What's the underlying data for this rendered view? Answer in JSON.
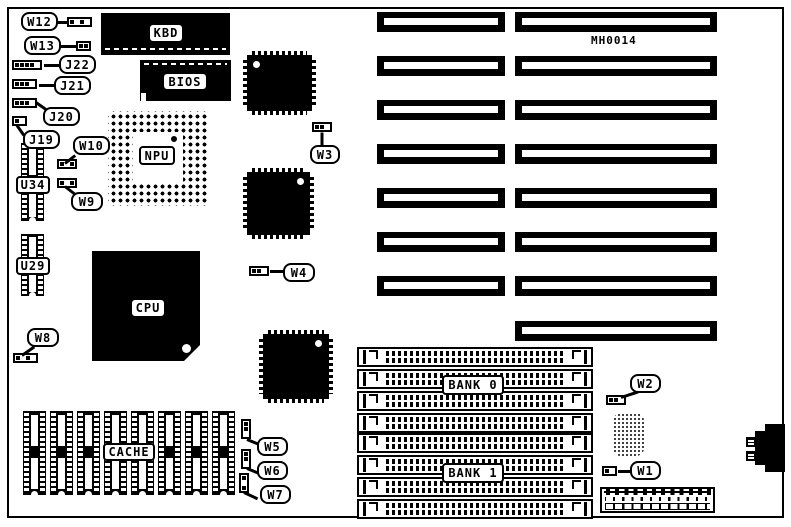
{
  "board": {
    "id_label": "MH0014",
    "colors": {
      "ink": "#000000",
      "paper": "#ffffff"
    },
    "chips": {
      "kbd": "KBD",
      "bios": "BIOS",
      "npu": "NPU",
      "cpu": "CPU",
      "cache": "CACHE",
      "u34": "U34",
      "u29": "U29"
    },
    "memory": {
      "bank0": "BANK 0",
      "bank1": "BANK 1"
    },
    "jumpers": {
      "w12": {
        "label": "W12",
        "pattern": [
          1,
          0,
          1,
          0
        ],
        "dir": "h"
      },
      "w13": {
        "label": "W13",
        "pattern": [
          1,
          1
        ],
        "dir": "h"
      },
      "j22": {
        "label": "J22",
        "pattern": [
          1,
          1,
          1,
          1,
          0
        ],
        "dir": "h"
      },
      "j21": {
        "label": "J21",
        "pattern": [
          1,
          1,
          1,
          0
        ],
        "dir": "h"
      },
      "j20": {
        "label": "J20",
        "pattern": [
          1,
          1,
          1,
          0
        ],
        "dir": "h"
      },
      "j19": {
        "label": "J19",
        "pattern": [
          1,
          0
        ],
        "dir": "h"
      },
      "w10": {
        "label": "W10",
        "pattern": [
          1,
          0,
          1
        ],
        "dir": "h"
      },
      "w9": {
        "label": "W9",
        "pattern": [
          1,
          0,
          1
        ],
        "dir": "h"
      },
      "w8": {
        "label": "W8",
        "pattern": [
          1,
          0,
          1,
          0
        ],
        "dir": "h"
      },
      "w5": {
        "label": "W5",
        "pattern": [
          1,
          1,
          0
        ],
        "dir": "v"
      },
      "w6": {
        "label": "W6",
        "pattern": [
          1,
          1,
          0
        ],
        "dir": "v"
      },
      "w7": {
        "label": "W7",
        "pattern": [
          1,
          0,
          1
        ],
        "dir": "v"
      },
      "w3": {
        "label": "W3",
        "pattern": [
          1,
          1,
          0
        ],
        "dir": "h"
      },
      "w4": {
        "label": "W4",
        "pattern": [
          1,
          1,
          0
        ],
        "dir": "h"
      },
      "w2": {
        "label": "W2",
        "pattern": [
          1,
          1,
          0
        ],
        "dir": "h"
      },
      "w1": {
        "label": "W1",
        "pattern": [
          1,
          0
        ],
        "dir": "h"
      }
    }
  }
}
